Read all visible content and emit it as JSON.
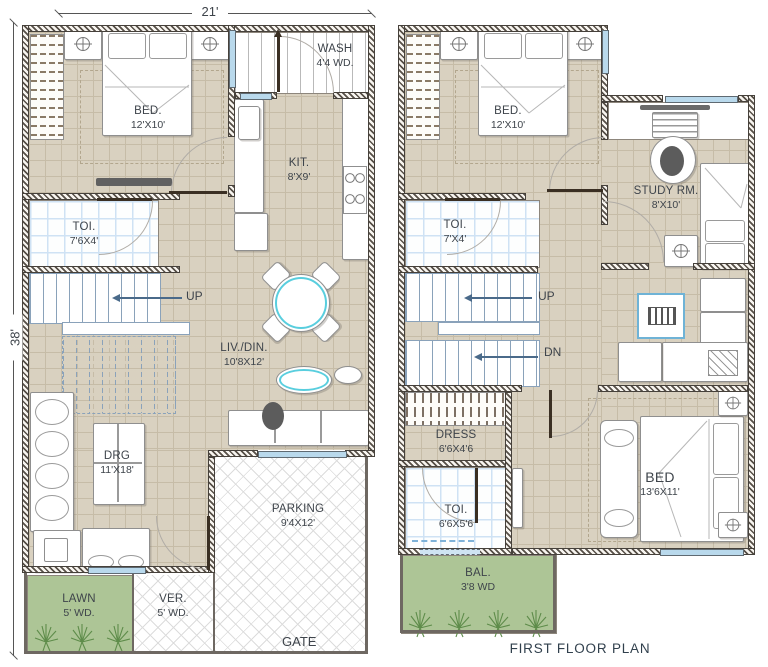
{
  "type": "floor_plan_drawing",
  "ground_floor": {
    "dim_w": "21'",
    "dim_h": "38'",
    "bed": {
      "name": "BED.",
      "size": "12'X10'"
    },
    "wash": {
      "name": "WASH",
      "size": "4'4 WD."
    },
    "kit": {
      "name": "KIT.",
      "size": "8'X9'"
    },
    "toi": {
      "name": "TOI.",
      "size": "7'6X4'"
    },
    "livdin": {
      "name": "LIV./DIN.",
      "size": "10'8X12'"
    },
    "drg": {
      "name": "DRG",
      "size": "11'X18'"
    },
    "parking": {
      "name": "PARKING",
      "size": "9'4X12'"
    },
    "lawn": {
      "name": "LAWN",
      "size": "5' WD."
    },
    "ver": {
      "name": "VER.",
      "size": "5' WD."
    },
    "up": "UP",
    "gate": "GATE"
  },
  "first_floor": {
    "caption": "FIRST FLOOR PLAN",
    "bed": {
      "name": "BED.",
      "size": "12'X10'"
    },
    "study": {
      "name": "STUDY RM.",
      "size": "8'X10'"
    },
    "toi_upper": {
      "name": "TOI.",
      "size": "7'X4'"
    },
    "dress": {
      "name": "DRESS",
      "size": "6'6X4'6"
    },
    "toi_lower": {
      "name": "TOI.",
      "size": "6'6X5'6"
    },
    "bed_master": {
      "name": "BED",
      "size": "13'6X11'"
    },
    "bal": {
      "name": "BAL.",
      "size": "3'8 WD"
    },
    "up": "UP",
    "dn": "DN"
  },
  "colors": {
    "floor_tan": "#d9d1c0",
    "wall_hatch": "#575048",
    "tile_blue": "#cfe2f4",
    "window_blue": "#b9d9ec",
    "lawn_green": "#adc596",
    "accent_cyan": "#59cede",
    "stair_blue": "#8aa2ba",
    "text": "#3e444b"
  }
}
